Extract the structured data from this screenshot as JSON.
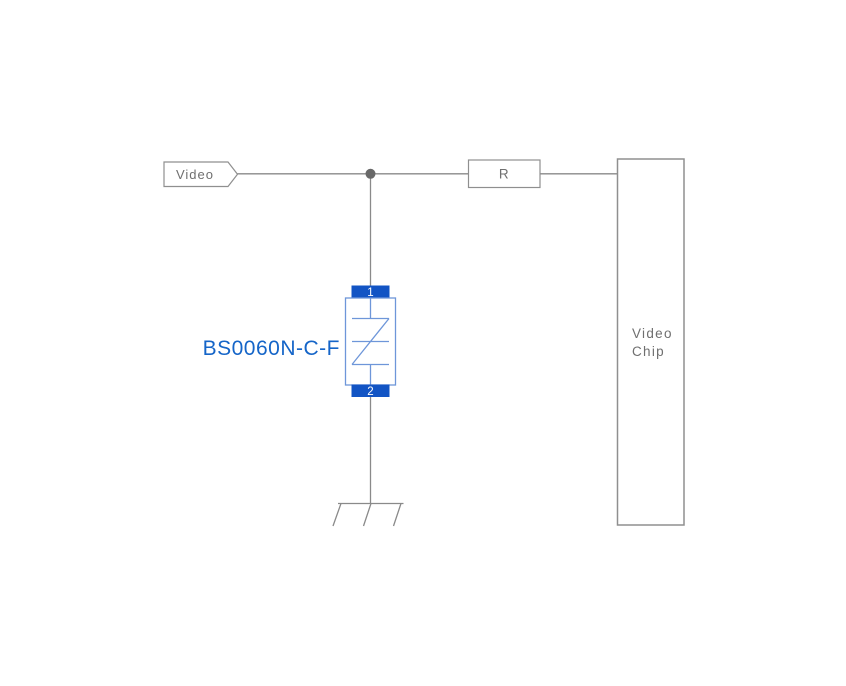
{
  "diagram": {
    "kind": "circuit-schematic",
    "background": "#ffffff",
    "colors": {
      "wire": "#8a8a8a",
      "box_outline": "#8f8f8f",
      "gray_text": "#6f6f6f",
      "junction_dot": "#686868",
      "tvs_pin_fill": "#1254c4",
      "tvs_pin_text": "#ffffff",
      "tvs_body_outline": "#6e96d9",
      "tvs_label_blue": "#1565c8"
    },
    "net_flag": {
      "label": "Video"
    },
    "resistor": {
      "label": "R"
    },
    "chip": {
      "label_line1": "Video",
      "label_line2": "Chip"
    },
    "tvs": {
      "part_number": "BS0060N-C-F",
      "pin_top": "1",
      "pin_bottom": "2"
    },
    "ground": {
      "symbol": "chassis-ground"
    }
  }
}
